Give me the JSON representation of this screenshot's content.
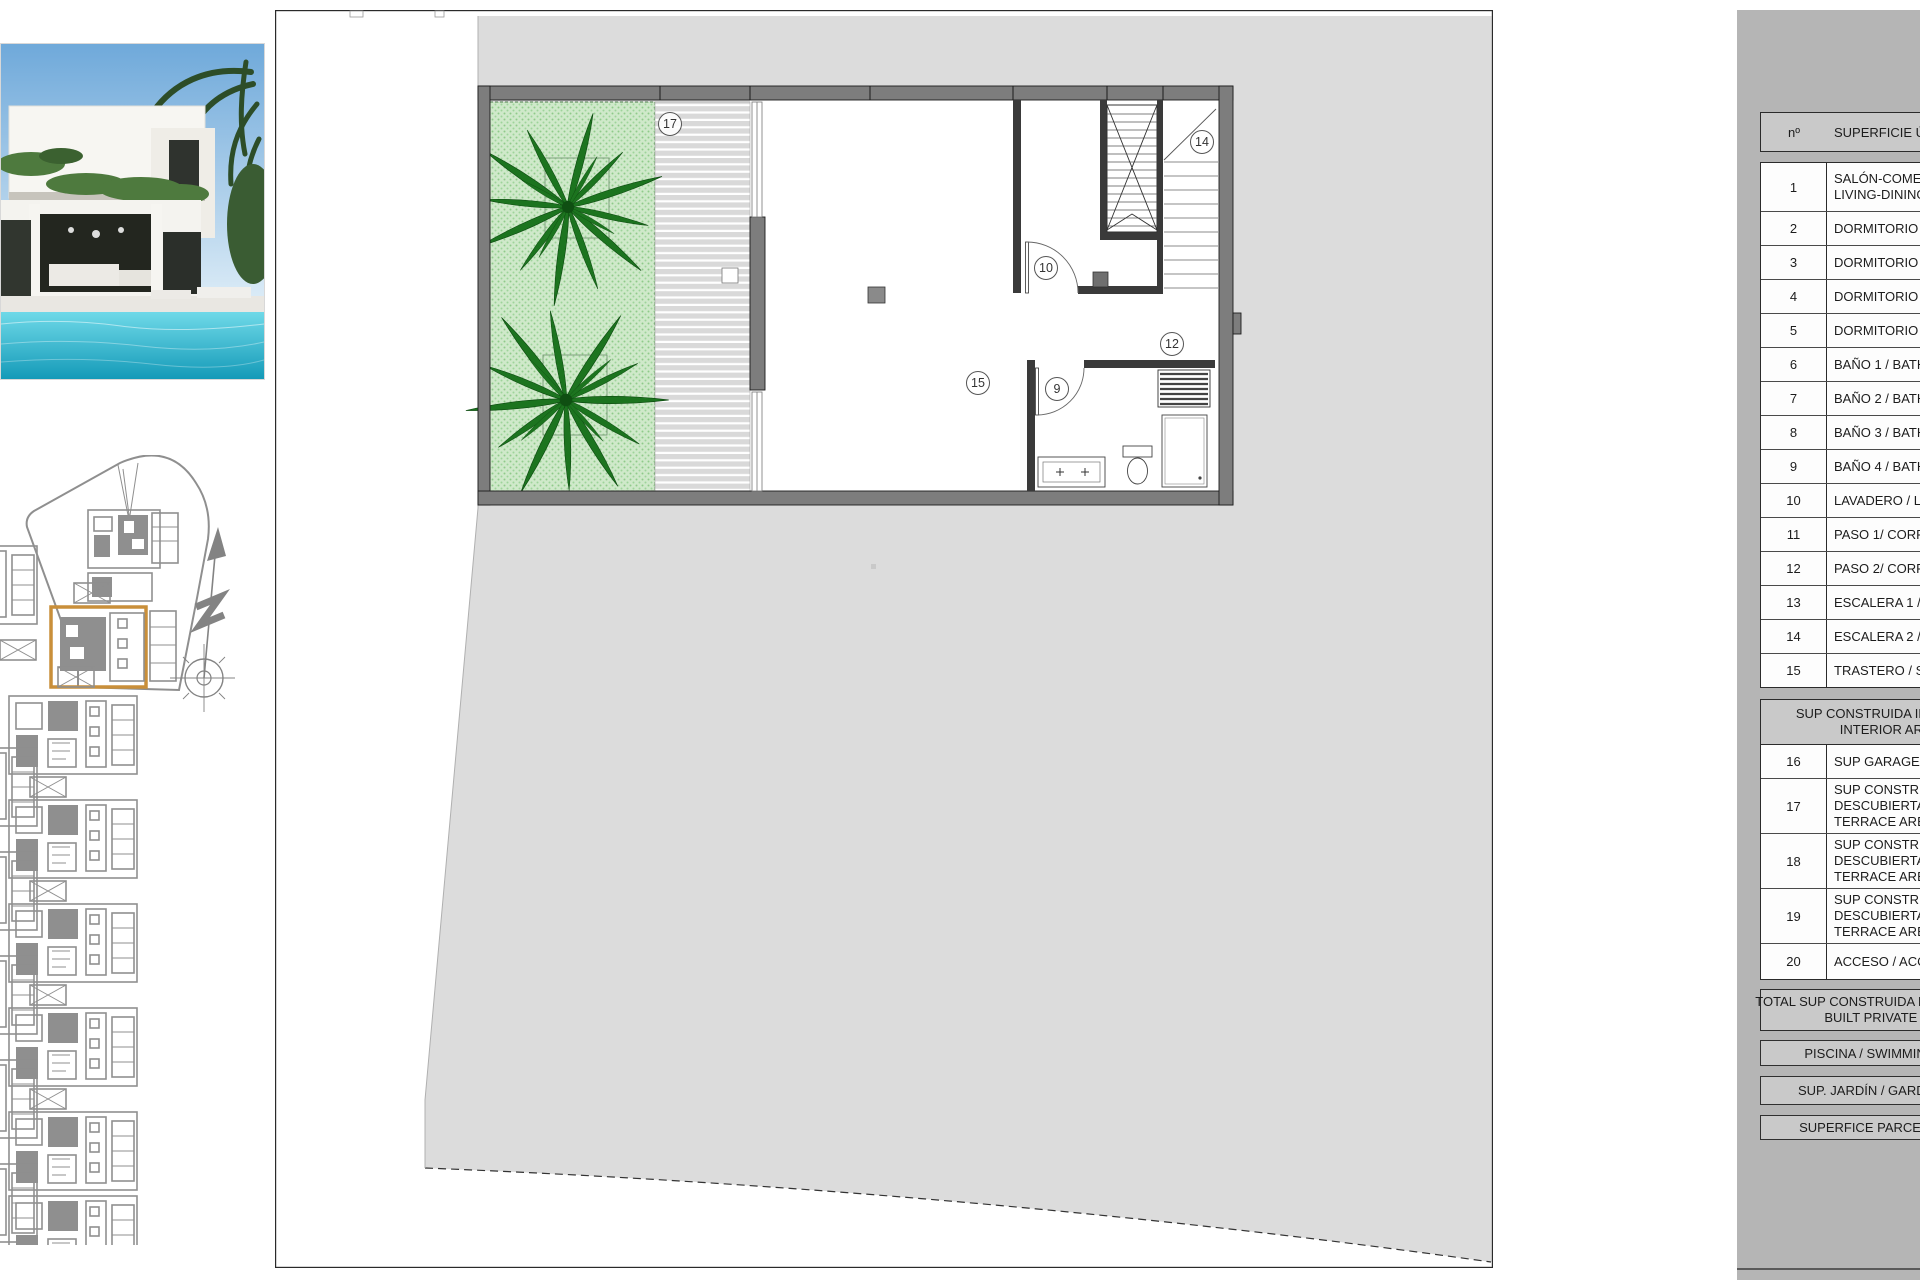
{
  "sheet": {
    "type": "architectural floor plan sheet"
  },
  "colors": {
    "parcel_gray": "#dcdcdc",
    "panel_gray": "#b5b5b5",
    "table_fill_gray": "#c9c9c9",
    "wall_gray": "#7d7d7d",
    "garden_green": "#cfe9ca",
    "palm_green": "#1c741f",
    "highlight_orange": "#c98f3a",
    "pool_teal": "#35c3d8"
  },
  "floor_plan": {
    "room_labels": [
      {
        "id": "label-17",
        "text": "17"
      },
      {
        "id": "label-14",
        "text": "14"
      },
      {
        "id": "label-10",
        "text": "10"
      },
      {
        "id": "label-12",
        "text": "12"
      },
      {
        "id": "label-15",
        "text": "15"
      },
      {
        "id": "label-9",
        "text": "9"
      }
    ]
  },
  "table": {
    "header": {
      "col_num": "nº",
      "col_name": "SUPERFICIE ÚTIL"
    },
    "rooms": [
      {
        "n": "1",
        "lines": [
          "SALÓN-COMEDOR /",
          "LIVING-DINING"
        ]
      },
      {
        "n": "2",
        "lines": [
          "DORMITORIO 1"
        ]
      },
      {
        "n": "3",
        "lines": [
          "DORMITORIO 2"
        ]
      },
      {
        "n": "4",
        "lines": [
          "DORMITORIO 3"
        ]
      },
      {
        "n": "5",
        "lines": [
          "DORMITORIO 4"
        ]
      },
      {
        "n": "6",
        "lines": [
          "BAÑO 1 / BATH 1"
        ]
      },
      {
        "n": "7",
        "lines": [
          "BAÑO 2 / BATH 2"
        ]
      },
      {
        "n": "8",
        "lines": [
          "BAÑO 3 / BATH 3"
        ]
      },
      {
        "n": "9",
        "lines": [
          "BAÑO 4 / BATH 4"
        ]
      },
      {
        "n": "10",
        "lines": [
          "LAVADERO / LAUNDRY"
        ]
      },
      {
        "n": "11",
        "lines": [
          "PASO 1/ CORRIDOR 1"
        ]
      },
      {
        "n": "12",
        "lines": [
          "PASO 2/ CORRIDOR 2"
        ]
      },
      {
        "n": "13",
        "lines": [
          "ESCALERA 1 / STAIRS 1"
        ]
      },
      {
        "n": "14",
        "lines": [
          "ESCALERA 2 / STAIRS 2"
        ]
      },
      {
        "n": "15",
        "lines": [
          "TRASTERO / STORAGE"
        ]
      }
    ],
    "built_section": {
      "header_lines": [
        "SUP CONSTRUIDA INTERIOR /",
        "INTERIOR AREA"
      ],
      "rows": [
        {
          "n": "16",
          "lines": [
            "SUP GARAGE/ GARAGE"
          ]
        },
        {
          "n": "17",
          "lines": [
            "SUP CONSTRUIDA",
            "DESCUBIERTA /",
            "TERRACE AREA"
          ]
        },
        {
          "n": "18",
          "lines": [
            "SUP CONSTRUIDA",
            "DESCUBIERTA /",
            "TERRACE AREA"
          ]
        },
        {
          "n": "19",
          "lines": [
            "SUP CONSTRUIDA",
            "DESCUBIERTA /",
            "TERRACE AREA"
          ]
        },
        {
          "n": "20",
          "lines": [
            "ACCESO / ACCESS"
          ]
        }
      ]
    },
    "total": {
      "lines": [
        "TOTAL SUP CONSTRUIDA PRIVADA / TOTAL",
        "BUILT PRIVATE AREA"
      ]
    },
    "summary_bars": [
      "PISCINA / SWIMMING POOL",
      "SUP. JARDÍN / GARDEN AREA",
      "SUPERFICE PARCELA / PLOT"
    ]
  }
}
